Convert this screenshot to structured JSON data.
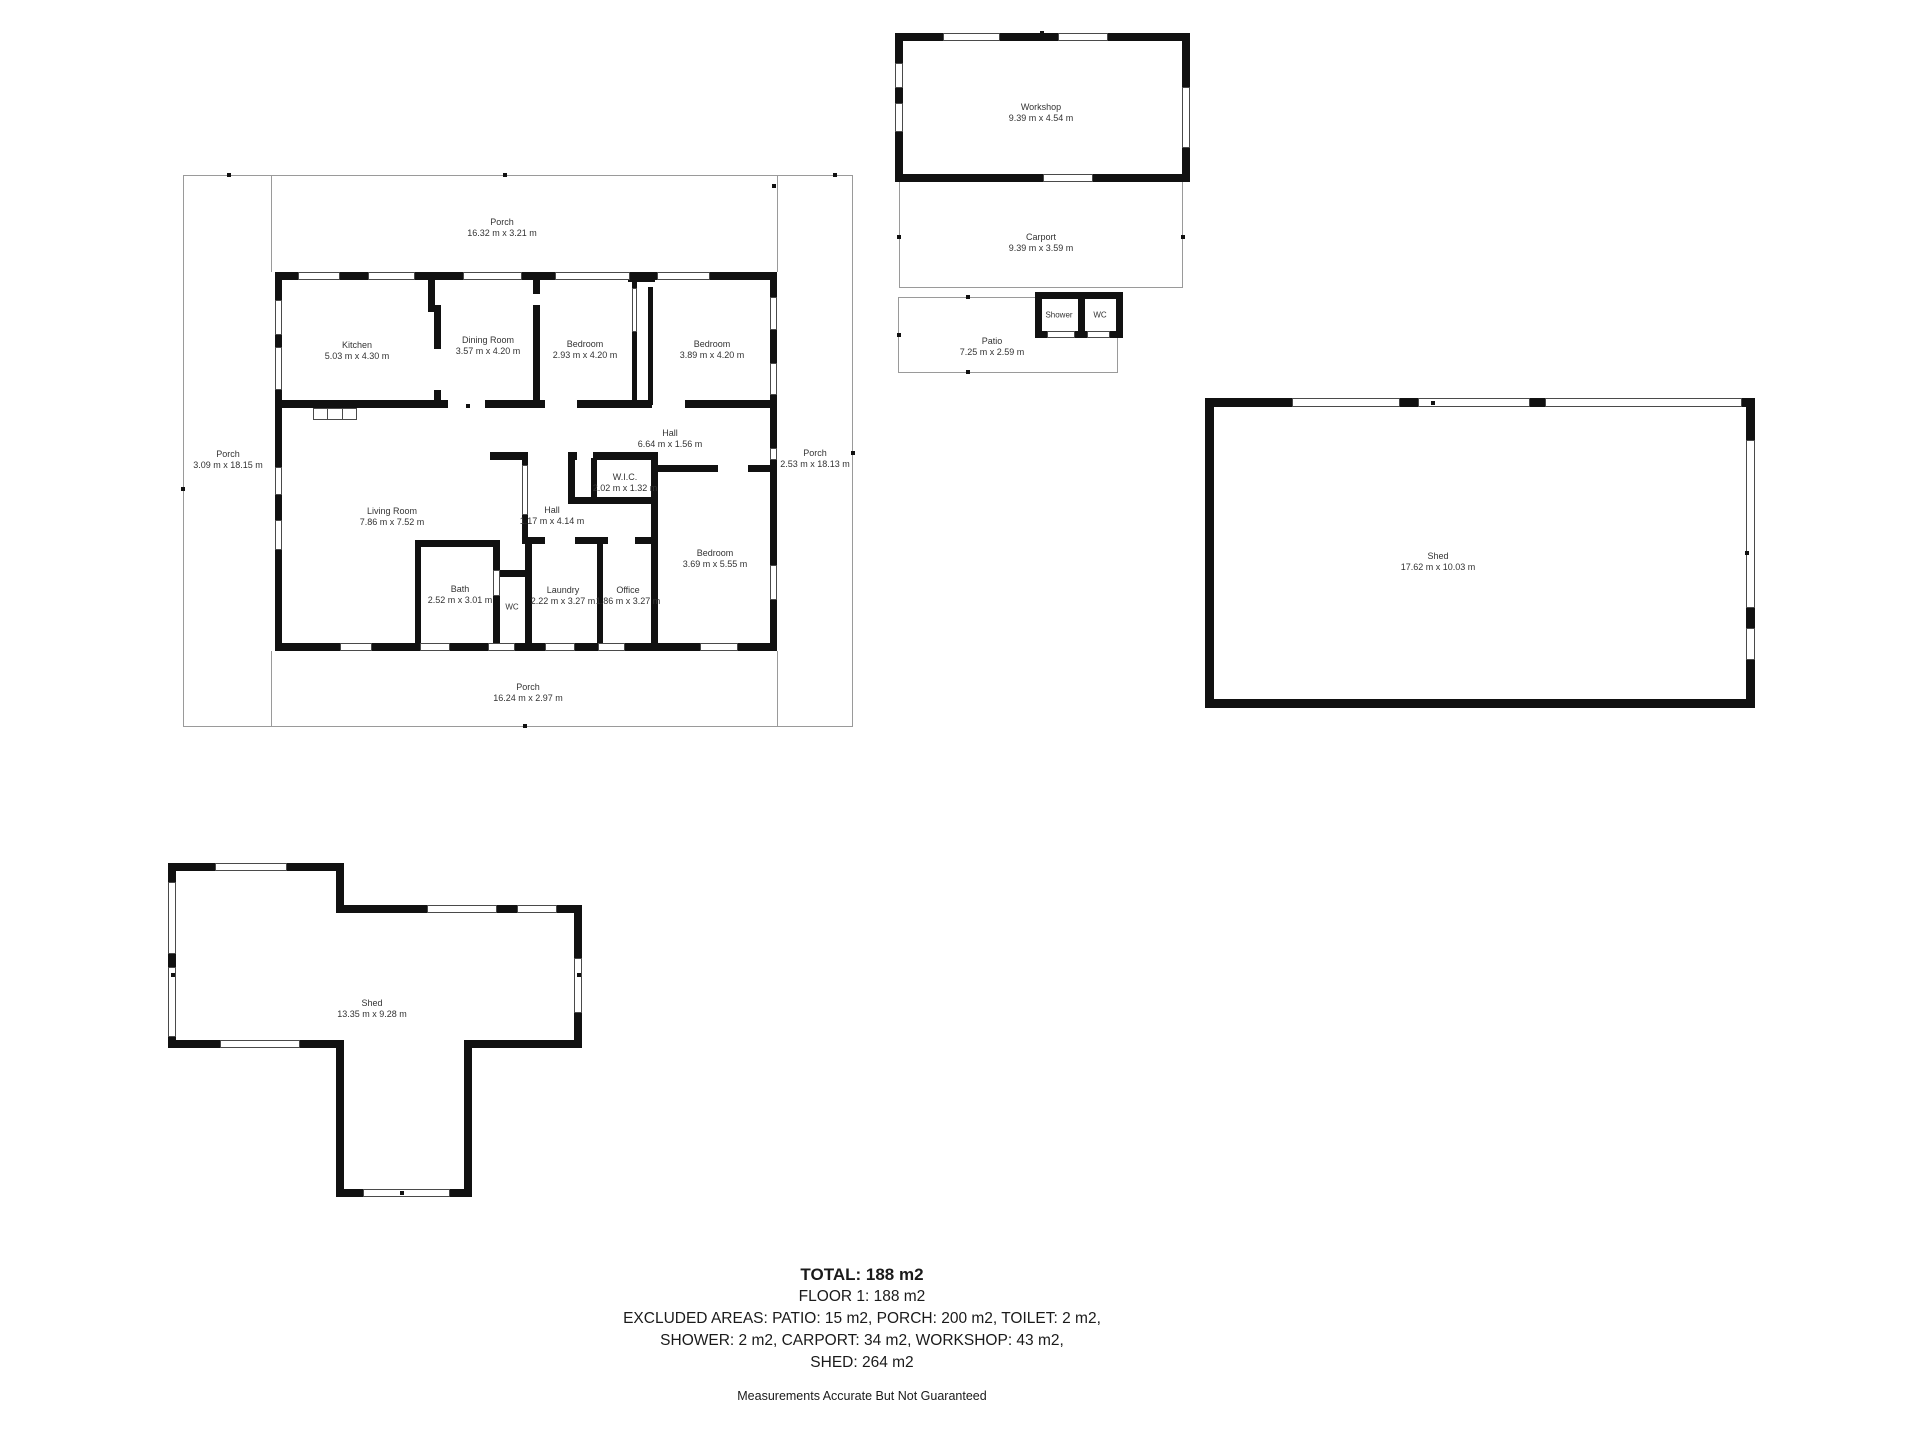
{
  "colors": {
    "wall": "#111111",
    "thin_line": "#9a9a9a",
    "text": "#333333",
    "background": "#ffffff"
  },
  "rooms": {
    "kitchen": {
      "name": "Kitchen",
      "dims": "5.03 m x 4.30 m"
    },
    "dining": {
      "name": "Dining Room",
      "dims": "3.57 m x 4.20 m"
    },
    "bedroom1": {
      "name": "Bedroom",
      "dims": "2.93 m x 4.20 m"
    },
    "bedroom2": {
      "name": "Bedroom",
      "dims": "3.89 m x 4.20 m"
    },
    "hall_upper": {
      "name": "Hall",
      "dims": "6.64 m x 1.56 m"
    },
    "wic": {
      "name": "W.I.C.",
      "dims": "2.02 m x 1.32 m"
    },
    "hall_lower": {
      "name": "Hall",
      "dims": "1.17 m x 4.14 m"
    },
    "living": {
      "name": "Living Room",
      "dims": "7.86 m x 7.52 m"
    },
    "bath": {
      "name": "Bath",
      "dims": "2.52 m x 3.01 m"
    },
    "wc": {
      "name": "WC"
    },
    "laundry": {
      "name": "Laundry",
      "dims": "2.22 m x 3.27 m"
    },
    "office": {
      "name": "Office",
      "dims": "1.86 m x 3.27 m"
    },
    "bedroom3": {
      "name": "Bedroom",
      "dims": "3.69 m x 5.55 m"
    }
  },
  "porches": {
    "top": {
      "name": "Porch",
      "dims": "16.32 m x 3.21 m"
    },
    "left": {
      "name": "Porch",
      "dims": "3.09 m x 18.15 m"
    },
    "right": {
      "name": "Porch",
      "dims": "2.53 m x 18.13 m"
    },
    "bottom": {
      "name": "Porch",
      "dims": "16.24 m x 2.97 m"
    }
  },
  "outbuildings": {
    "workshop": {
      "name": "Workshop",
      "dims": "9.39 m x 4.54 m"
    },
    "carport": {
      "name": "Carport",
      "dims": "9.39 m x 3.59 m"
    },
    "shower": {
      "name": "Shower"
    },
    "wc": {
      "name": "WC"
    },
    "patio": {
      "name": "Patio",
      "dims": "7.25 m x 2.59 m"
    },
    "shed_right": {
      "name": "Shed",
      "dims": "17.62 m x 10.03 m"
    },
    "shed_left": {
      "name": "Shed",
      "dims": "13.35 m x 9.28 m"
    }
  },
  "summary": {
    "total": "TOTAL: 188 m2",
    "floor": "FLOOR 1: 188 m2",
    "excluded_line1": "EXCLUDED AREAS: PATIO: 15 m2, PORCH: 200 m2, TOILET: 2 m2,",
    "excluded_line2": "SHOWER: 2 m2, CARPORT: 34 m2, WORKSHOP: 43 m2,",
    "excluded_line3": "SHED: 264 m2",
    "disclaimer": "Measurements Accurate But Not Guaranteed"
  }
}
